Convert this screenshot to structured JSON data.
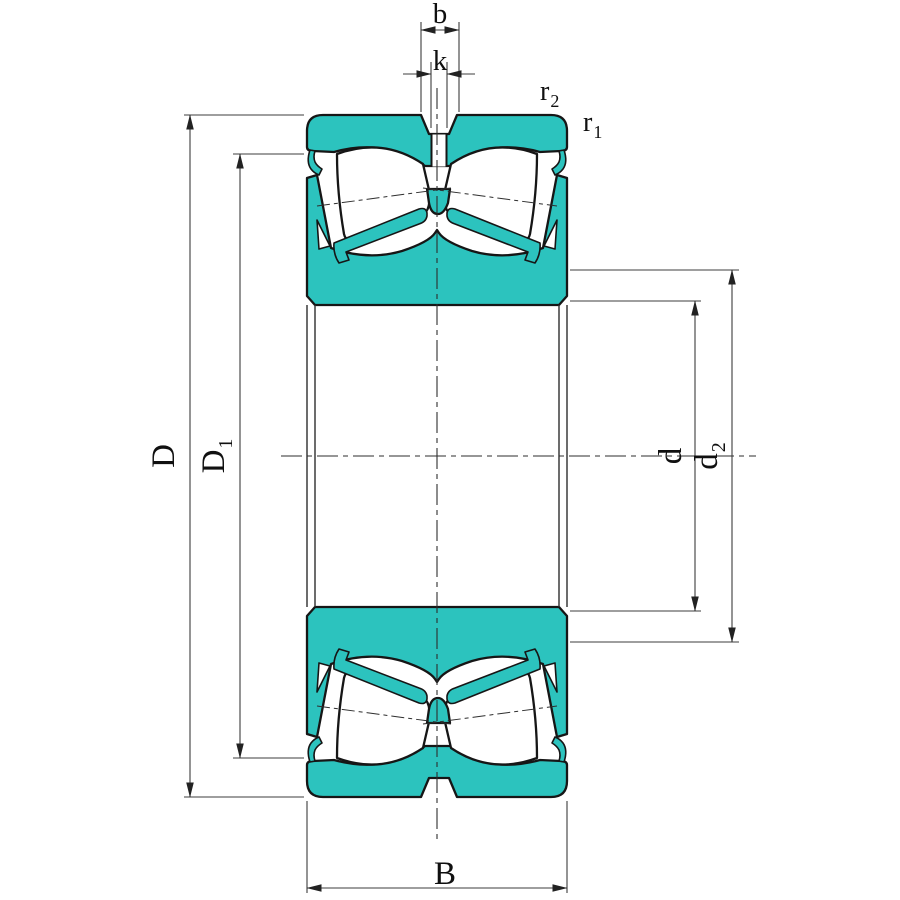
{
  "diagram": {
    "type": "bearing-cross-section",
    "labels": {
      "outer_diameter": {
        "main": "D",
        "sub": ""
      },
      "recess_diameter": {
        "main": "D",
        "sub": "1"
      },
      "bore_diameter": {
        "main": "d",
        "sub": ""
      },
      "shoulder_diameter": {
        "main": "d",
        "sub": "2"
      },
      "width": {
        "main": "B"
      },
      "groove_width": {
        "main": "b"
      },
      "hole_width": {
        "main": "k"
      },
      "chamfer_inner": {
        "main": "r",
        "sub": "1"
      },
      "chamfer_outer": {
        "main": "r",
        "sub": "2"
      }
    },
    "colors": {
      "ring_fill": "#2cc3be",
      "outline": "#161616",
      "dim_line": "#3c3c3c",
      "text": "#101010",
      "background": "#ffffff"
    }
  }
}
